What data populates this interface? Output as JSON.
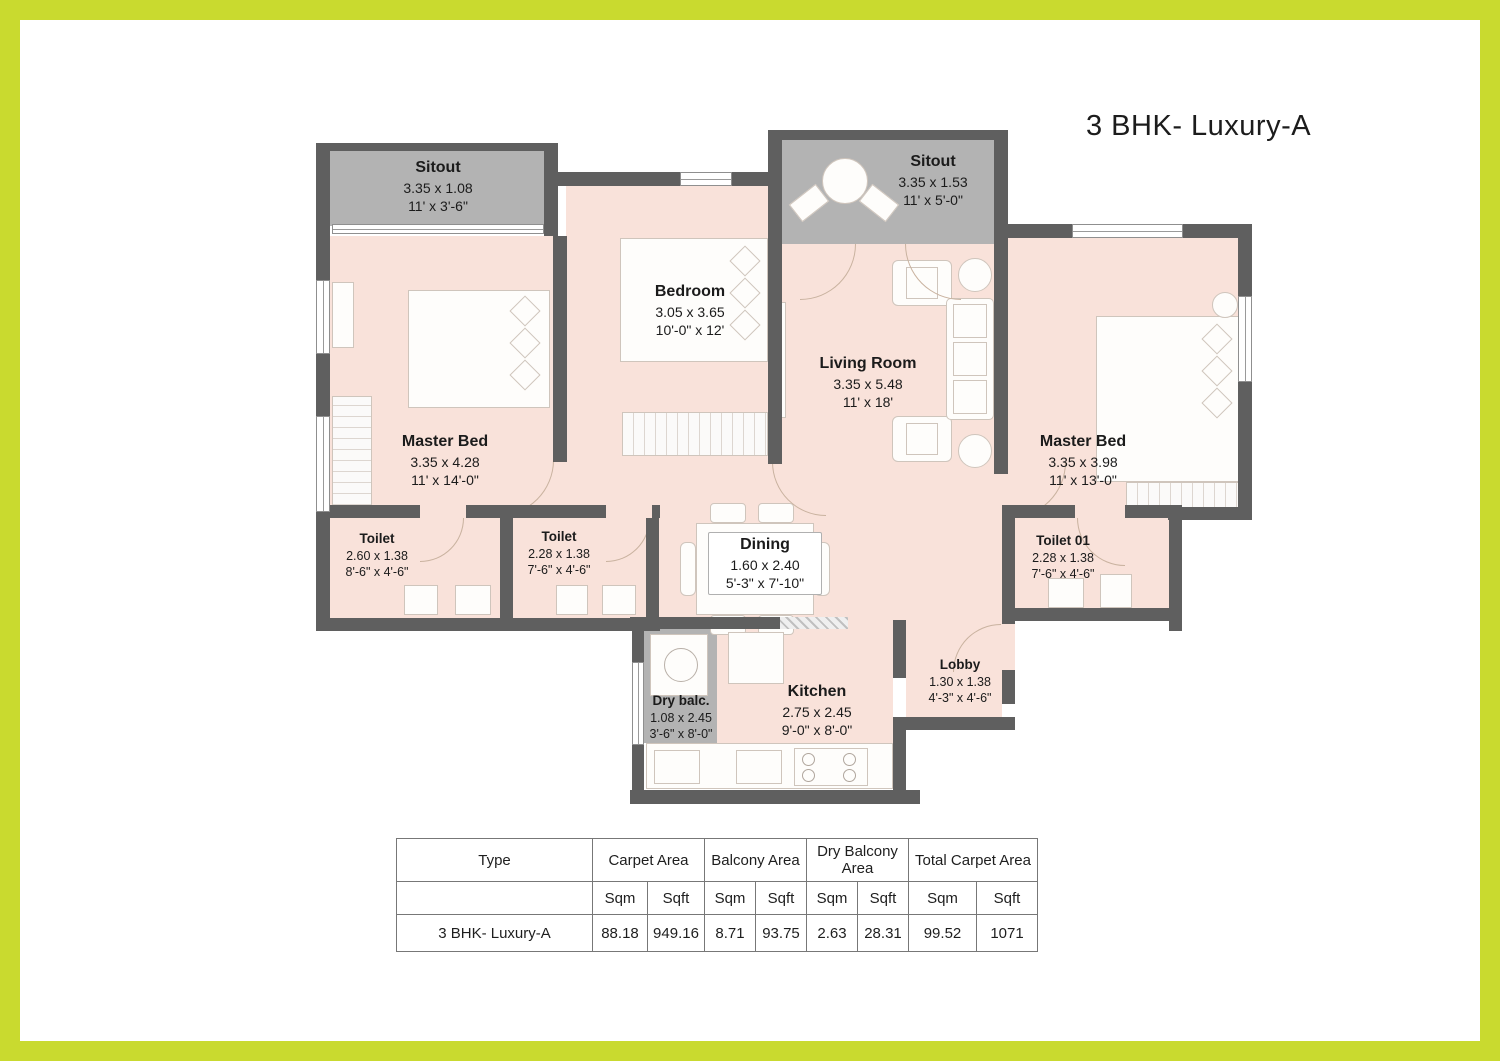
{
  "title": "3 BHK- Luxury-A",
  "rooms": {
    "sitout_left": {
      "name": "Sitout",
      "m": "3.35 x 1.08",
      "ft": "11' x 3'-6\""
    },
    "sitout_top": {
      "name": "Sitout",
      "m": "3.35 x 1.53",
      "ft": "11' x 5'-0\""
    },
    "bedroom": {
      "name": "Bedroom",
      "m": "3.05 x 3.65",
      "ft": "10'-0\" x 12'"
    },
    "living": {
      "name": "Living Room",
      "m": "3.35 x 5.48",
      "ft": "11' x 18'"
    },
    "master_left": {
      "name": "Master Bed",
      "m": "3.35 x 4.28",
      "ft": "11' x 14'-0\""
    },
    "master_right": {
      "name": "Master Bed",
      "m": "3.35 x 3.98",
      "ft": "11' x 13'-0\""
    },
    "toilet_left": {
      "name": "Toilet",
      "m": "2.60 x 1.38",
      "ft": "8'-6\" x 4'-6\""
    },
    "toilet_mid": {
      "name": "Toilet",
      "m": "2.28 x 1.38",
      "ft": "7'-6\" x 4'-6\""
    },
    "toilet_01": {
      "name": "Toilet 01",
      "m": "2.28 x 1.38",
      "ft": "7'-6\" x 4'-6\""
    },
    "dining": {
      "name": "Dining",
      "m": "1.60 x 2.40",
      "ft": "5'-3\" x 7'-10\""
    },
    "kitchen": {
      "name": "Kitchen",
      "m": "2.75 x 2.45",
      "ft": "9'-0\" x 8'-0\""
    },
    "dry_balc": {
      "name": "Dry balc.",
      "m": "1.08 x 2.45",
      "ft": "3'-6\" x 8'-0\""
    },
    "lobby": {
      "name": "Lobby",
      "m": "1.30 x 1.38",
      "ft": "4'-3\" x 4'-6\""
    }
  },
  "table": {
    "col_groups": [
      "Type",
      "Carpet Area",
      "Balcony Area",
      "Dry Balcony Area",
      "Total Carpet Area"
    ],
    "sub_headers": [
      "Sqm",
      "Sqft",
      "Sqm",
      "Sqft",
      "Sqm",
      "Sqft",
      "Sqm",
      "Sqft"
    ],
    "rows": [
      [
        "3 BHK- Luxury-A",
        "88.18",
        "949.16",
        "8.71",
        "93.75",
        "2.63",
        "28.31",
        "99.52",
        "1071"
      ]
    ]
  },
  "colors": {
    "frame": "#c9da2f",
    "wall": "#5f5f5f",
    "floor": "#f9e2da",
    "balcony": "#b3b3b3"
  }
}
